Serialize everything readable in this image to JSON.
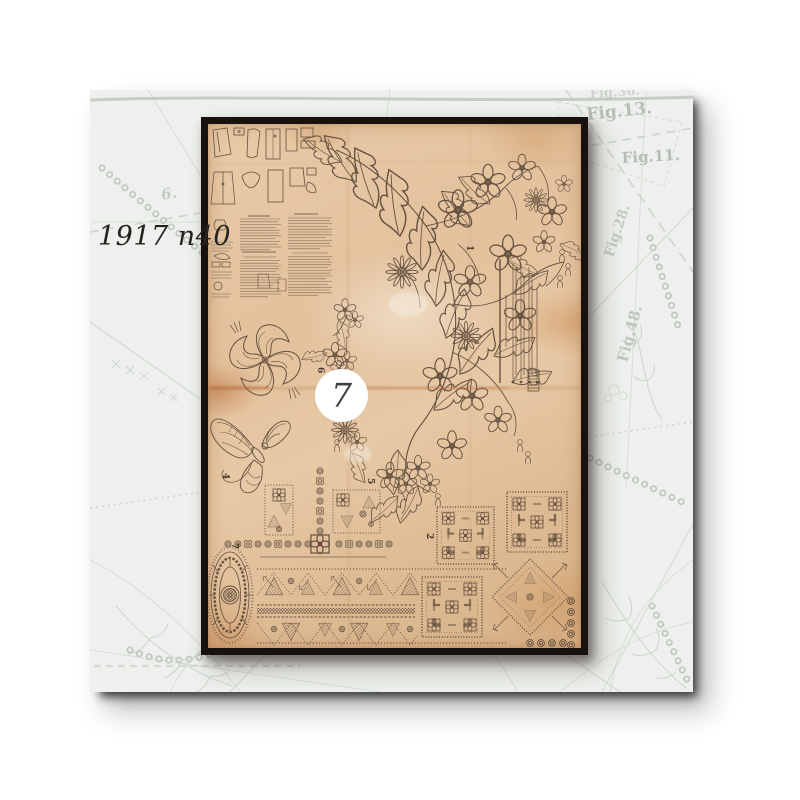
{
  "overlay": {
    "year_label": "1917 n40",
    "sheet_number": "7"
  },
  "background": {
    "fig_labels": [
      "Fig.36.",
      "Fig.13.",
      "Fig.11.",
      "Fig.28.",
      "Fig.48.",
      "6."
    ]
  },
  "sheet": {
    "piece_numbers": [
      "1",
      "2",
      "4",
      "5",
      "6",
      "7"
    ]
  },
  "colors": {
    "page_bg": "#ffffff",
    "pattern_bg": "#edf0ec",
    "pattern_line": "#c6cbc5",
    "paper": "#e2c09b",
    "paper_ink": "#63503f",
    "frame": "#17120e",
    "badge_bg": "#ffffff",
    "badge_text": "#40403e",
    "year_text": "#24231f"
  }
}
